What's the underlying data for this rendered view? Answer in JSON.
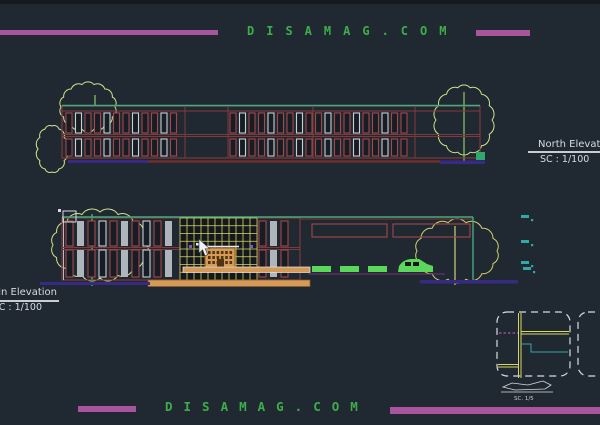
{
  "watermark": {
    "top_text": "DISAMAG.COM",
    "bottom_text": "DISAMAG.COM",
    "text_color": "#3cae4a",
    "bar_color": "#a9559d"
  },
  "labels": {
    "north_title": "North Elevation",
    "north_scale": "SC : 1/100",
    "main_title": "Main Elevation",
    "main_scale": "SC : 1/100",
    "detail_scale": "SC. 1/5"
  },
  "colors": {
    "background": "#202831",
    "building_outline_red": "#7e3a3a",
    "window_red": "#a34848",
    "window_white": "#c9ced1",
    "roof_green": "#46ab7e",
    "tree_yellow_green": "#cfe48c",
    "curtain_grid_yellow": "#d6d861",
    "entrance_orange": "#d59a58",
    "ground_purple": "#372a85",
    "ground_dark_red": "#6e2f2f",
    "level_mark_teal": "#2fa8a8",
    "landscape_green": "#5bd85b",
    "label_white": "#d6dbdf"
  }
}
